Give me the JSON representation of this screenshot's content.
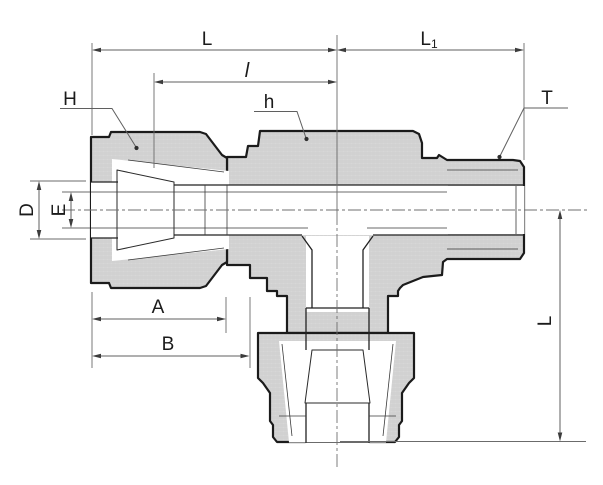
{
  "drawing": {
    "labels": {
      "length_overall": "L",
      "length_right_main": "L",
      "length_right_sub": "1",
      "length_center": "l",
      "nut_hex": "H",
      "body_hex": "h",
      "thread": "T",
      "port_diameter": "D",
      "bore_diameter": "E",
      "nut_length": "A",
      "body_length": "B",
      "branch_length": "L"
    },
    "colors": {
      "outline": "#1b1b1b",
      "metal_fill": "#d6d6d6",
      "dimension_lines": "#5f5f5f",
      "background": "#ffffff"
    }
  }
}
